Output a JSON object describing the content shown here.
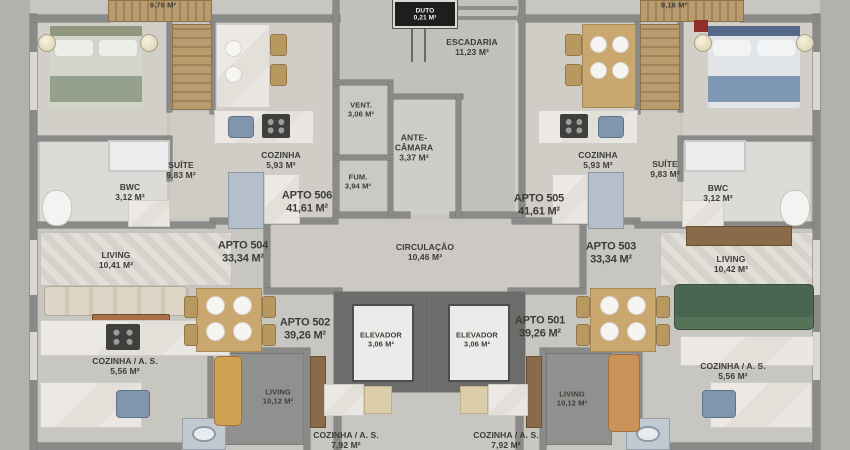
{
  "plan": {
    "units": {
      "apto506": {
        "name": "APTO 506",
        "area": "41,61 M²"
      },
      "apto505": {
        "name": "APTO 505",
        "area": "41,61 M²"
      },
      "apto504": {
        "name": "APTO 504",
        "area": "33,34 M²"
      },
      "apto503": {
        "name": "APTO 503",
        "area": "33,34 M²"
      },
      "apto502": {
        "name": "APTO 502",
        "area": "39,26 M²"
      },
      "apto501": {
        "name": "APTO 501",
        "area": "39,26 M²"
      }
    },
    "rooms": {
      "duto": {
        "name": "DUTO",
        "area": "0,21 M²"
      },
      "escadaria": {
        "name": "ESCADARIA",
        "area": "11,23 M²"
      },
      "vent": {
        "name": "VENT.",
        "area": "3,06 M²"
      },
      "antecamara": {
        "line1": "ANTE-",
        "line2": "CÂMARA",
        "area": "3,37 M²"
      },
      "fum": {
        "name": "FUM.",
        "area": "3,94 M²"
      },
      "circulacao": {
        "name": "CIRCULAÇÃO",
        "area": "10,46 M²"
      },
      "elevador1": {
        "name": "ELEVADOR",
        "area": "3,06 M²"
      },
      "elevador2": {
        "name": "ELEVADOR",
        "area": "3,06 M²"
      },
      "suite_left": {
        "name": "SUÍTE",
        "area": "9,83 M²"
      },
      "suite_right": {
        "name": "SUÍTE",
        "area": "9,83 M²"
      },
      "bwc_left": {
        "name": "BWC",
        "area": "3,12 M²"
      },
      "bwc_right": {
        "name": "BWC",
        "area": "3,12 M²"
      },
      "cozinha_left": {
        "name": "COZINHA",
        "area": "5,93 M²"
      },
      "cozinha_right": {
        "name": "COZINHA",
        "area": "5,93 M²"
      },
      "living_504": {
        "name": "LIVING",
        "area": "10,41 M²"
      },
      "living_503": {
        "name": "LIVING",
        "area": "10,42 M²"
      },
      "living_502": {
        "name": "LIVING",
        "area": "10,12 M²"
      },
      "living_501": {
        "name": "LIVING",
        "area": "10,12 M²"
      },
      "cozinha_as_504": {
        "name": "COZINHA / A. S.",
        "area": "5,56 M²"
      },
      "cozinha_as_503": {
        "name": "COZINHA / A. S.",
        "area": "5,56 M²"
      },
      "cozinha_as_502": {
        "name": "COZINHA / A. S.",
        "area": "7,92 M²"
      },
      "cozinha_as_501": {
        "name": "COZINHA / A. S.",
        "area": "7,92 M²"
      },
      "closet_left": {
        "area": "9,76 M²"
      },
      "closet_right": {
        "area": "9,16 M²"
      }
    },
    "colors": {
      "floor": "#c8c6c0",
      "wall": "#8a8a88",
      "marble": "#e9e7e2",
      "wood": "#caa76f",
      "wood_dark": "#8a6a48",
      "appliance_blue": "#b4bfca",
      "sink_blue": "#8195ac",
      "sofa_cream": "#d8d1c2",
      "sofa_green": "#4a6650",
      "sofa_tan": "#c9935a",
      "bed_green": "#95a08c",
      "bed_blue": "#7e97b3",
      "dark_floor": "#90918f",
      "label_text": "#3c3c38",
      "duto_bg": "#1e1e1c",
      "duto_text": "#f2f2f0"
    }
  }
}
